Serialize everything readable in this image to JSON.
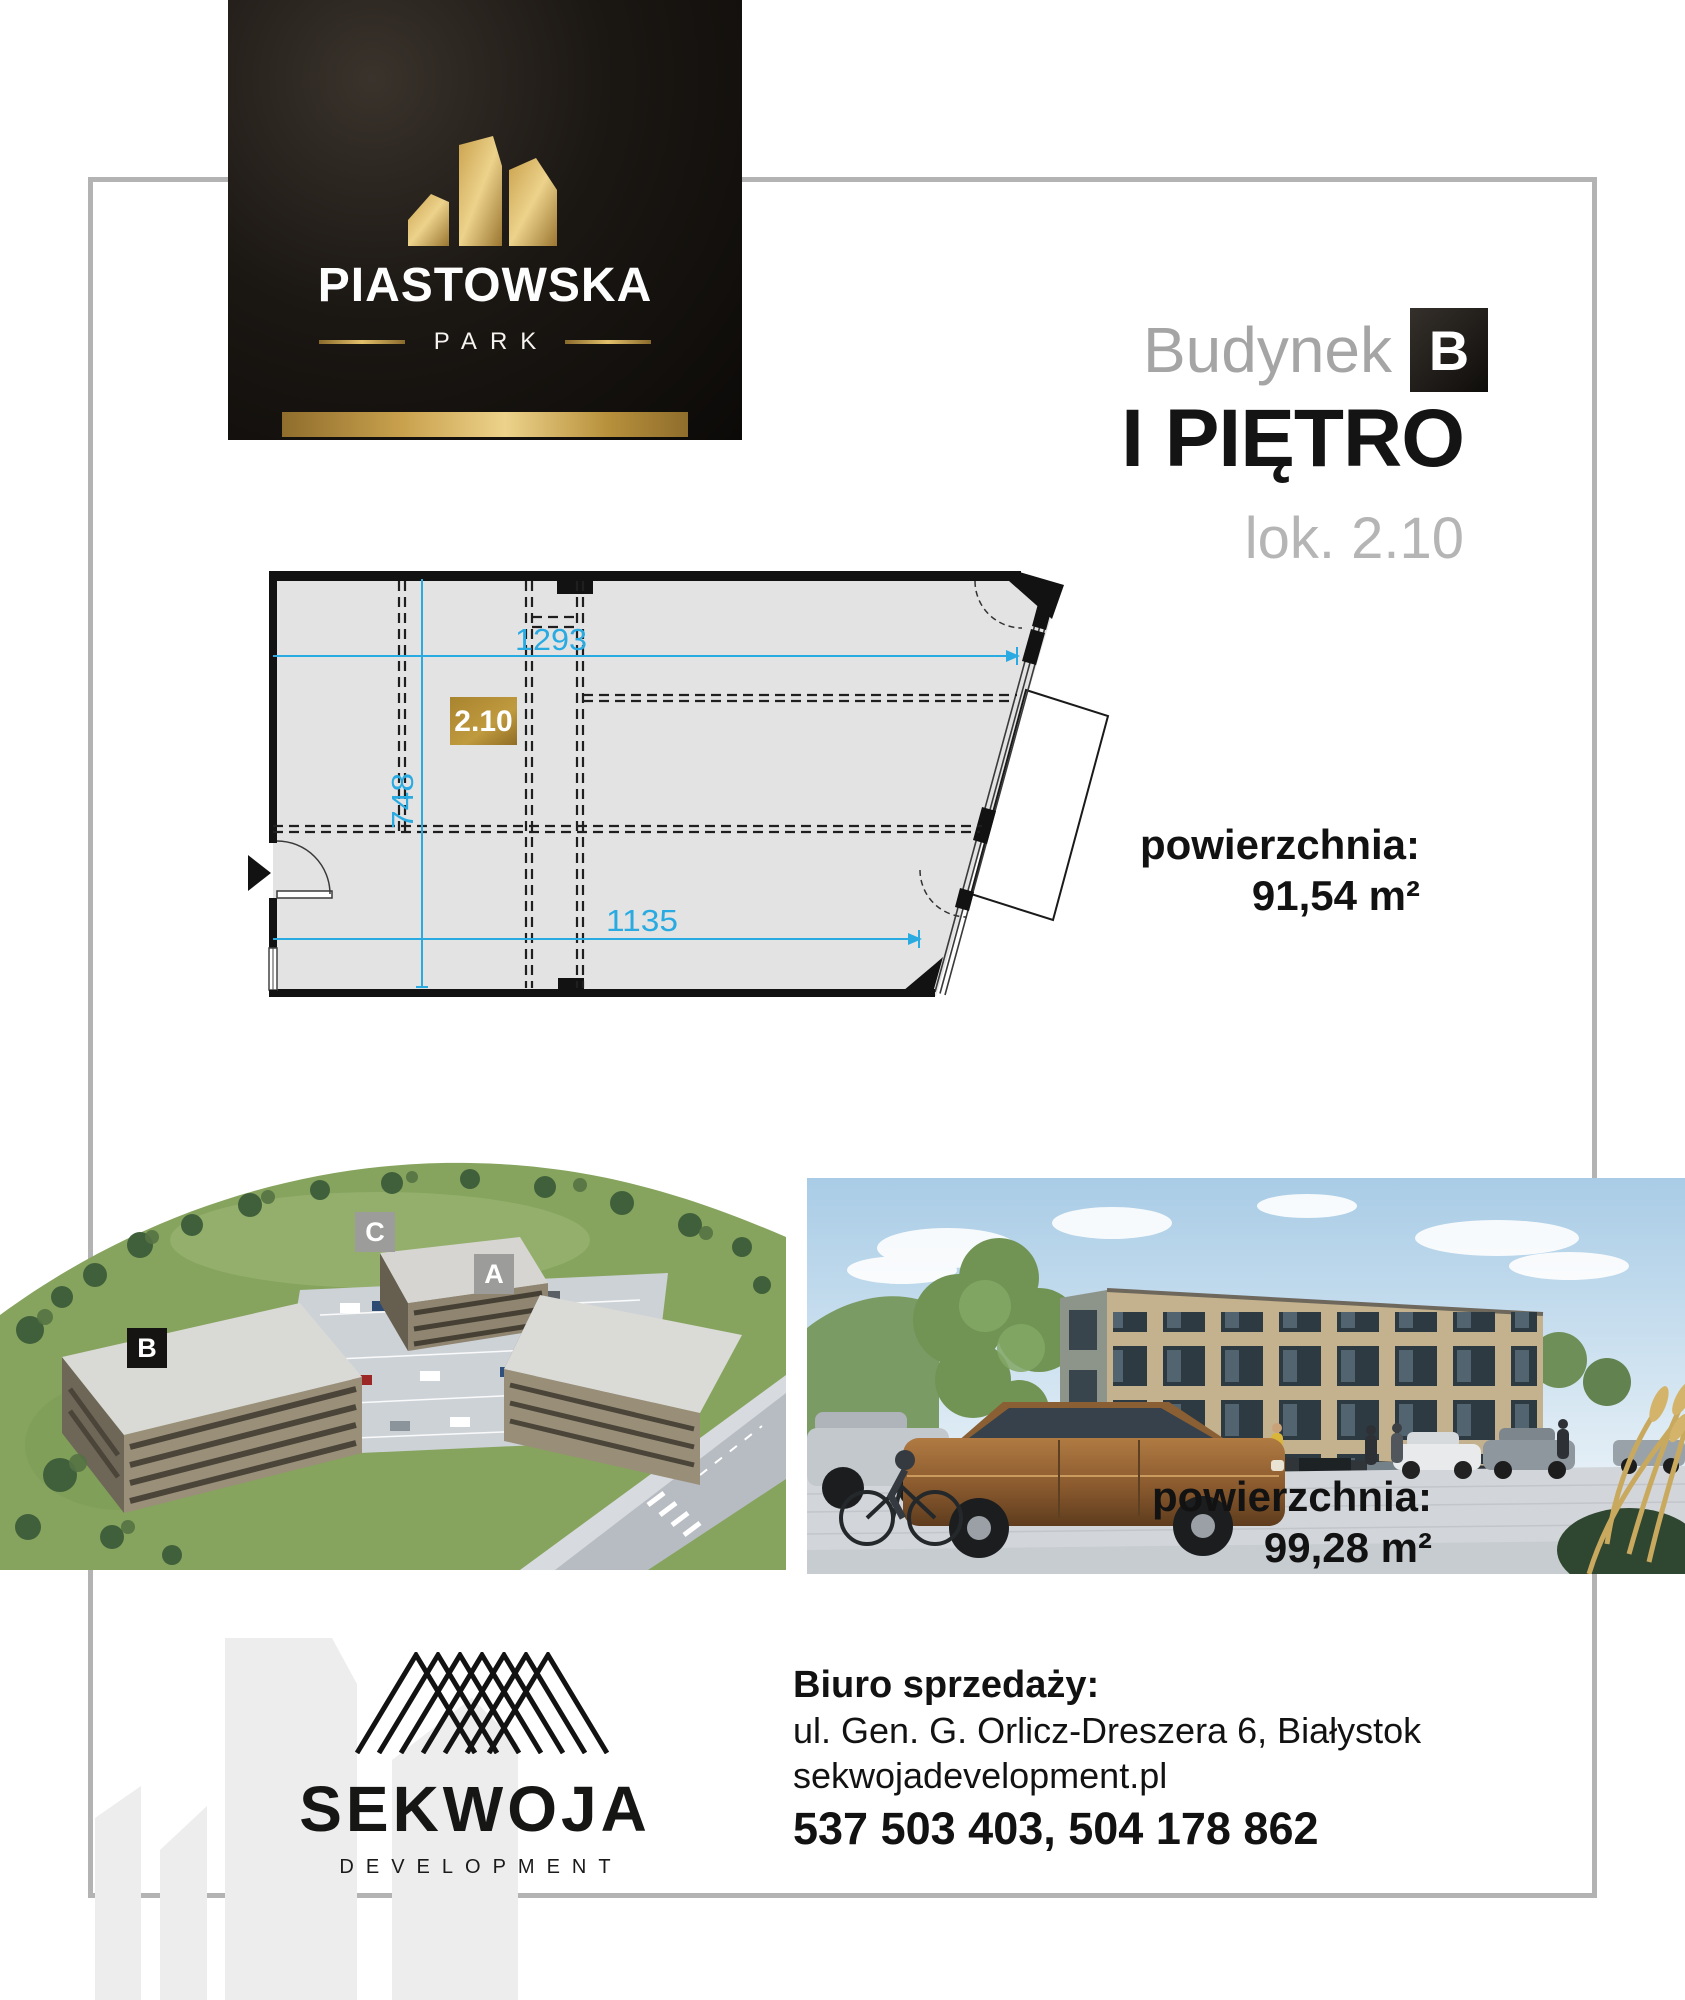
{
  "brand": {
    "name": "PIASTOWSKA",
    "tagline": "PARK"
  },
  "header": {
    "building_label": "Budynek",
    "building_letter": "B",
    "floor_title": "I PIĘTRO",
    "unit_subtitle": "lok. 2.10"
  },
  "floor_plan": {
    "unit_label": "2.10",
    "dim_width_top": "1293",
    "dim_height": "748",
    "dim_width_bottom": "1135"
  },
  "areas": {
    "primary": {
      "label": "powierzchnia:",
      "value": "91,54 m²"
    },
    "secondary": {
      "label": "powierzchnia:",
      "value": "99,28 m²"
    }
  },
  "site_plan": {
    "building_a": "A",
    "building_b": "B",
    "building_c": "C"
  },
  "developer": {
    "name": "SEKWOJA",
    "descriptor": "DEVELOPMENT"
  },
  "contact": {
    "office_label": "Biuro sprzedaży:",
    "address": "ul. Gen. G. Orlicz-Dreszera 6, Białystok",
    "website": "sekwojadevelopment.pl",
    "phones": "537 503 403, 504 178 862"
  },
  "colors": {
    "gold": "#c9a24b",
    "dimension_blue": "#29abe2",
    "frame_gray": "#b3b3b3",
    "label_gray": "#9c9c9a",
    "label_black": "#161412"
  }
}
